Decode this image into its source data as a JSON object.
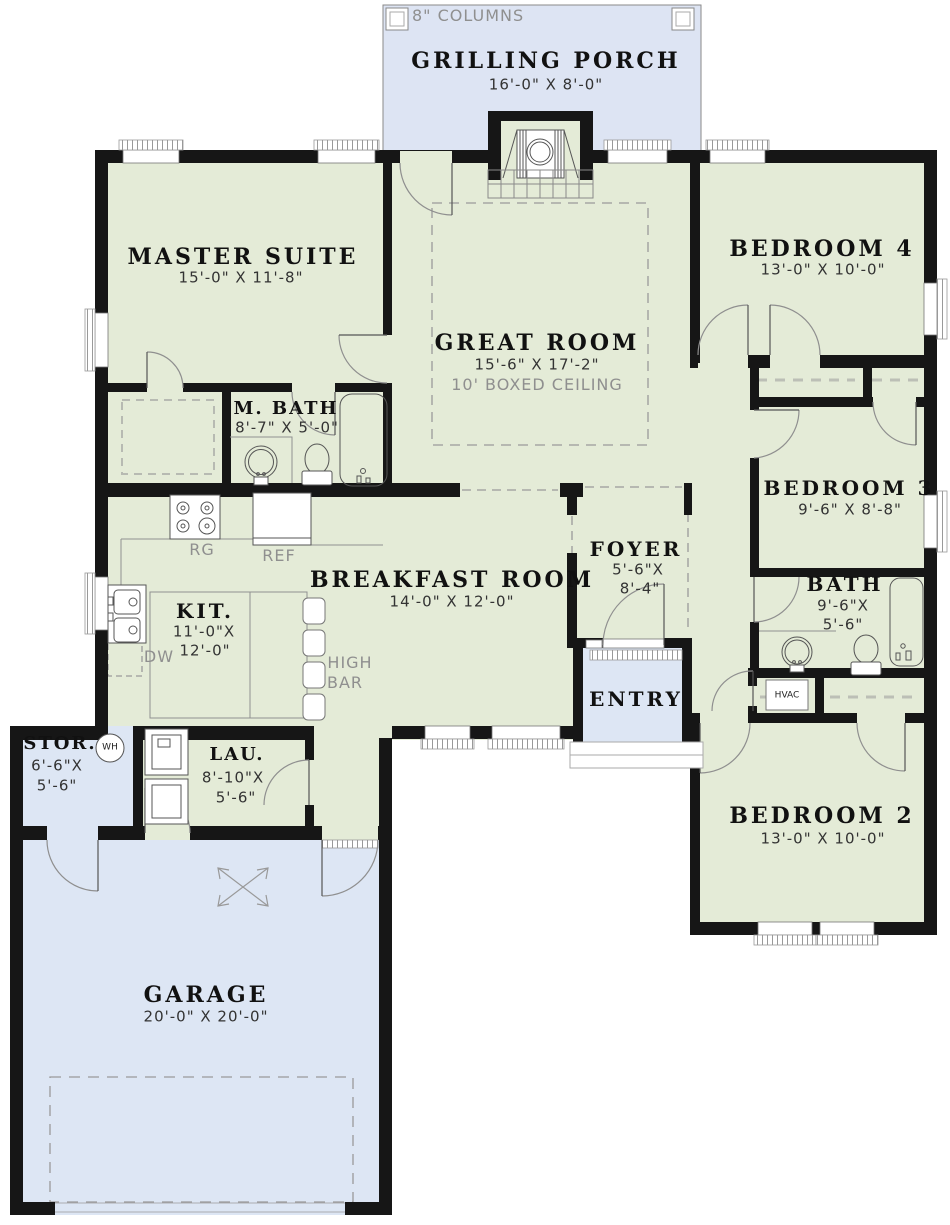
{
  "colors": {
    "room_fill": "#e4ebd7",
    "porch_fill": "#dde4f3",
    "garage_fill": "#dde6f4",
    "wall": "#161616",
    "line_gray": "#8f8f8f",
    "text_dark": "#1d1d1d",
    "text_gray": "#8f8f8f"
  },
  "labels": {
    "columns_note": "8\" COLUMNS",
    "porch": {
      "title": "GRILLING PORCH",
      "dims": "16'-0\" X 8'-0\""
    },
    "master": {
      "title": "MASTER SUITE",
      "dims": "15'-0\" X 11'-8\""
    },
    "great": {
      "title": "GREAT ROOM",
      "dims": "15'-6\" X 17'-2\"",
      "note": "10' BOXED CEILING"
    },
    "bedroom4": {
      "title": "BEDROOM 4",
      "dims": "13'-0\" X 10'-0\""
    },
    "mbath": {
      "title": "M. BATH",
      "dims": "8'-7\" X 5'-0\""
    },
    "bedroom3": {
      "title": "BEDROOM 3",
      "dims": "9'-6\" X 8'-8\""
    },
    "foyer": {
      "title": "FOYER",
      "dims1": "5'-6\"X",
      "dims2": "8'-4\""
    },
    "breakfast": {
      "title": "BREAKFAST ROOM",
      "dims": "14'-0\" X 12'-0\""
    },
    "kitchen": {
      "title": "KIT.",
      "dims1": "11'-0\"X",
      "dims2": "12'-0\""
    },
    "bath": {
      "title": "BATH",
      "dims1": "9'-6\"X",
      "dims2": "5'-6\""
    },
    "entry": {
      "title": "ENTRY"
    },
    "stor": {
      "title": "STOR.",
      "dims1": "6'-6\"X",
      "dims2": "5'-6\""
    },
    "laundry": {
      "title": "LAU.",
      "dims1": "8'-10\"X",
      "dims2": "5'-6\""
    },
    "bedroom2": {
      "title": "BEDROOM 2",
      "dims": "13'-0\" X 10'-0\""
    },
    "garage": {
      "title": "GARAGE",
      "dims": "20'-0\" X 20'-0\""
    },
    "appliances": {
      "range": "RG",
      "fridge": "REF",
      "dishwasher": "DW",
      "high_bar_line1": "HIGH",
      "high_bar_line2": "BAR",
      "water_heater": "WH",
      "hvac": "HVAC"
    }
  }
}
